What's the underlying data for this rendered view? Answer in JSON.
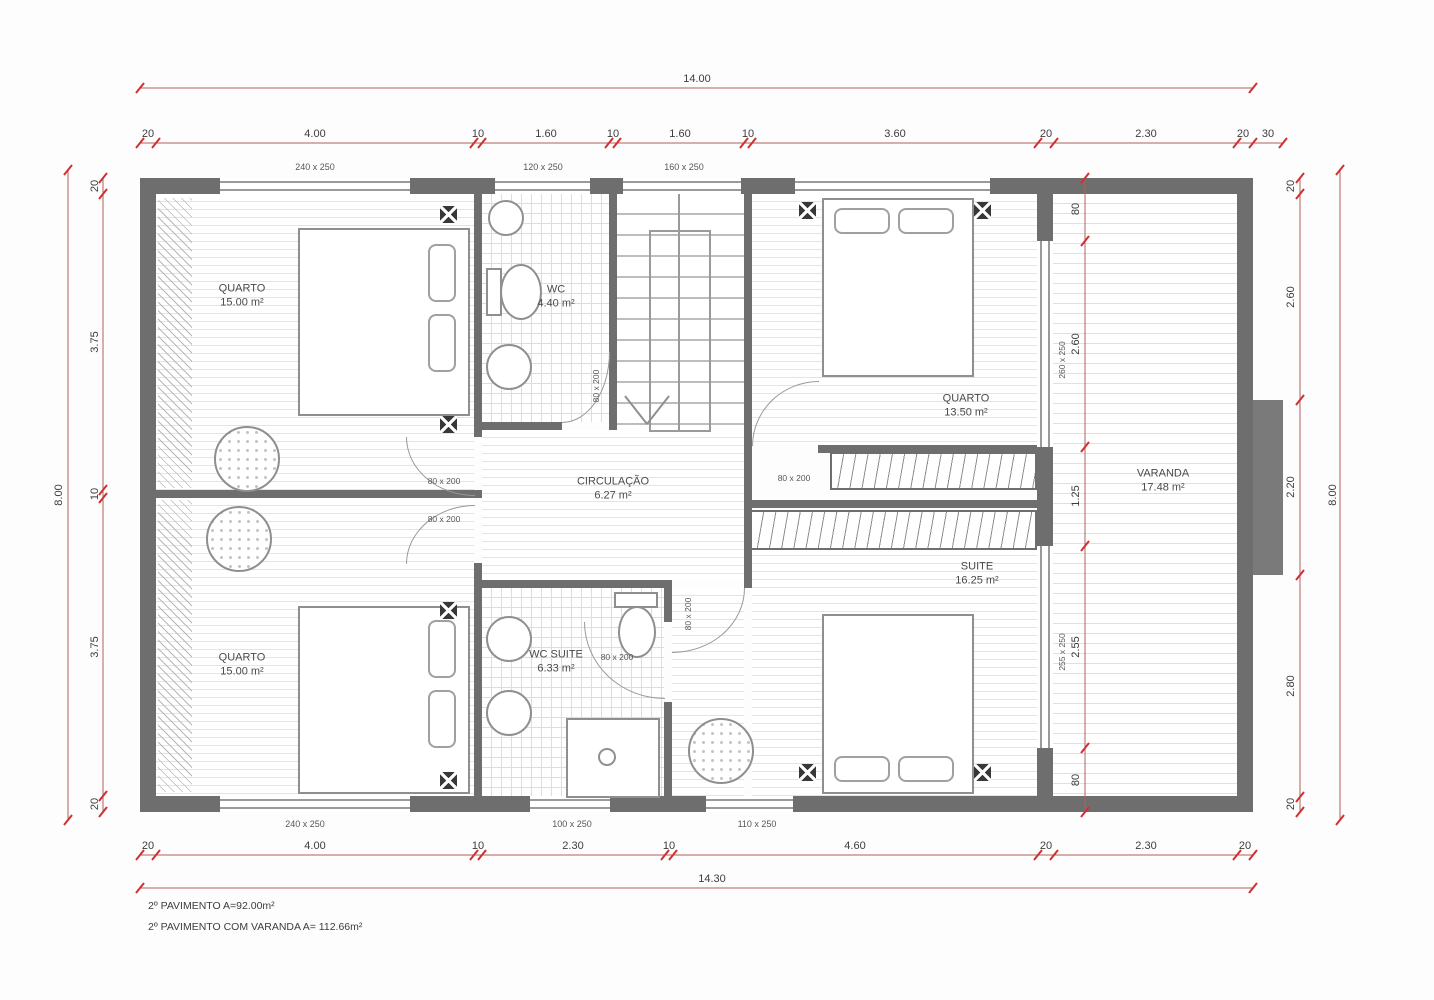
{
  "rooms": [
    {
      "name": "QUARTO",
      "area": "15.00 m²"
    },
    {
      "name": "WC",
      "area": "4.40 m²"
    },
    {
      "name": "QUARTO",
      "area": "13.50 m²"
    },
    {
      "name": "CIRCULAÇÃO",
      "area": "6.27 m²"
    },
    {
      "name": "VARANDA",
      "area": "17.48 m²"
    },
    {
      "name": "SUITE",
      "area": "16.25 m²"
    },
    {
      "name": "WC SUITE",
      "area": "6.33 m²"
    },
    {
      "name": "QUARTO",
      "area": "15.00 m²"
    }
  ],
  "dims": {
    "top_total": "14.00",
    "bottom_total": "14.30",
    "left_total": "8.00",
    "right_total": "8.00",
    "top": [
      "20",
      "4.00",
      "10",
      "1.60",
      "10",
      "1.60",
      "10",
      "3.60",
      "20",
      "2.30",
      "20",
      "30"
    ],
    "bottom": [
      "20",
      "4.00",
      "10",
      "2.30",
      "10",
      "4.60",
      "20",
      "2.30",
      "20"
    ],
    "left": [
      "20",
      "3.75",
      "10",
      "3.75",
      "20"
    ],
    "right": [
      "20",
      "2.60",
      "2.20",
      "2.80",
      "20"
    ],
    "interior": [
      "80",
      "2.60",
      "1.25",
      "2.55",
      "80"
    ]
  },
  "windows": {
    "top1": "240 x 250",
    "top2": "120 x 250",
    "top3": "160 x 250",
    "bottom1": "240 x 250",
    "bottom2": "100 x 250",
    "bottom3": "110 x 250",
    "balcony_top": "260 x 250",
    "balcony_bottom": "255 x 250"
  },
  "doors": {
    "wc": "80 x 200",
    "quarto_tl": "80 x 200",
    "quarto_bl": "80 x 200",
    "quarto_tr": "80 x 200",
    "suite": "80 x 200",
    "wc_suite": "80 x 200"
  },
  "notes": [
    "2º PAVIMENTO A=92.00m²",
    "2º PAVIMENTO COM VARANDA A= 112.66m²"
  ],
  "colors": {
    "dim_line": "#b0605c",
    "dim_tick": "#cf2f2f",
    "wall": "#6e6e6e"
  }
}
